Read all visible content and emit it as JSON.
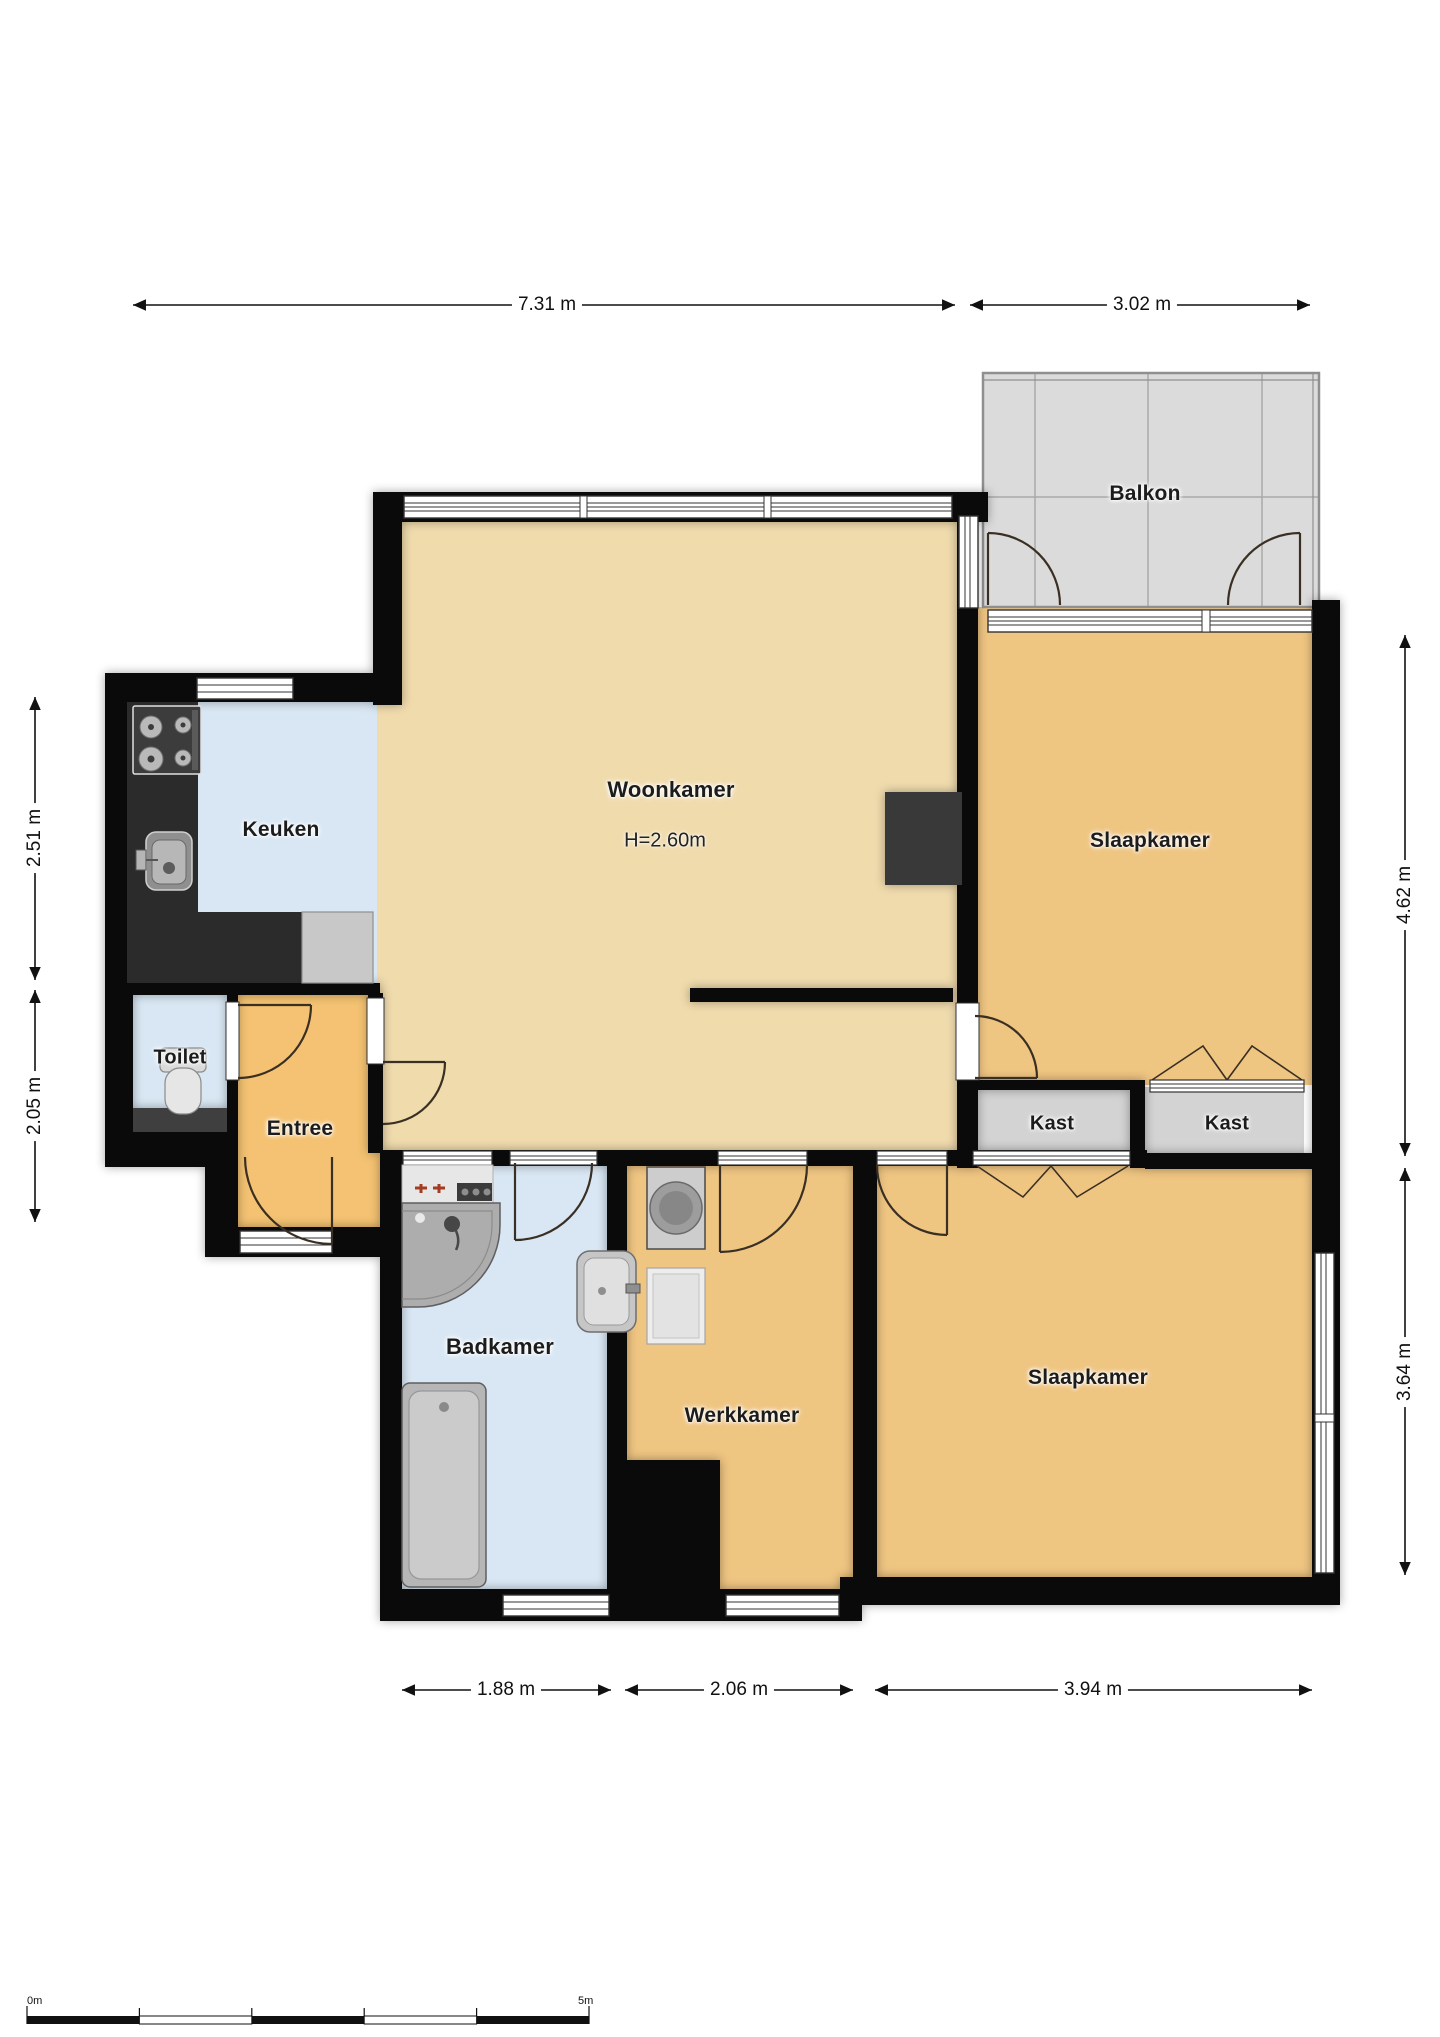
{
  "title": "Apartment floor plan",
  "labels": {
    "balkon": "Balkon",
    "woonkamer": "Woonkamer",
    "woonkamer_height": "H=2.60m",
    "slaapkamer_boven": "Slaapkamer",
    "keuken": "Keuken",
    "toilet": "Toilet",
    "entree": "Entree",
    "kast_links": "Kast",
    "kast_rechts": "Kast",
    "badkamer": "Badkamer",
    "werkkamer": "Werkkamer",
    "slaapkamer_onder": "Slaapkamer"
  },
  "dims": {
    "top_main": "7.31 m",
    "top_balkon": "3.02 m",
    "left_keuken": "2.51 m",
    "left_entree": "2.05 m",
    "right_slaapkamer_boven": "4.62 m",
    "right_slaapkamer_onder": "3.64 m",
    "bottom_badkamer": "1.88 m",
    "bottom_werkkamer": "2.06 m",
    "bottom_slaapkamer": "3.94 m"
  },
  "scale_bar": {
    "start": "0m",
    "end": "5m"
  },
  "colors": {
    "wall": "#0a0a0a",
    "floor_living": "#f0dbad",
    "floor_bedroom": "#efc582",
    "floor_wet_rooms": "#d9e7f4",
    "floor_entree": "#f4c272",
    "floor_closet": "#d3d3d3",
    "floor_balcony": "#dbdbdb",
    "kitchen_counter": "#2b2b2b",
    "door_arc": "#3a2f23"
  }
}
